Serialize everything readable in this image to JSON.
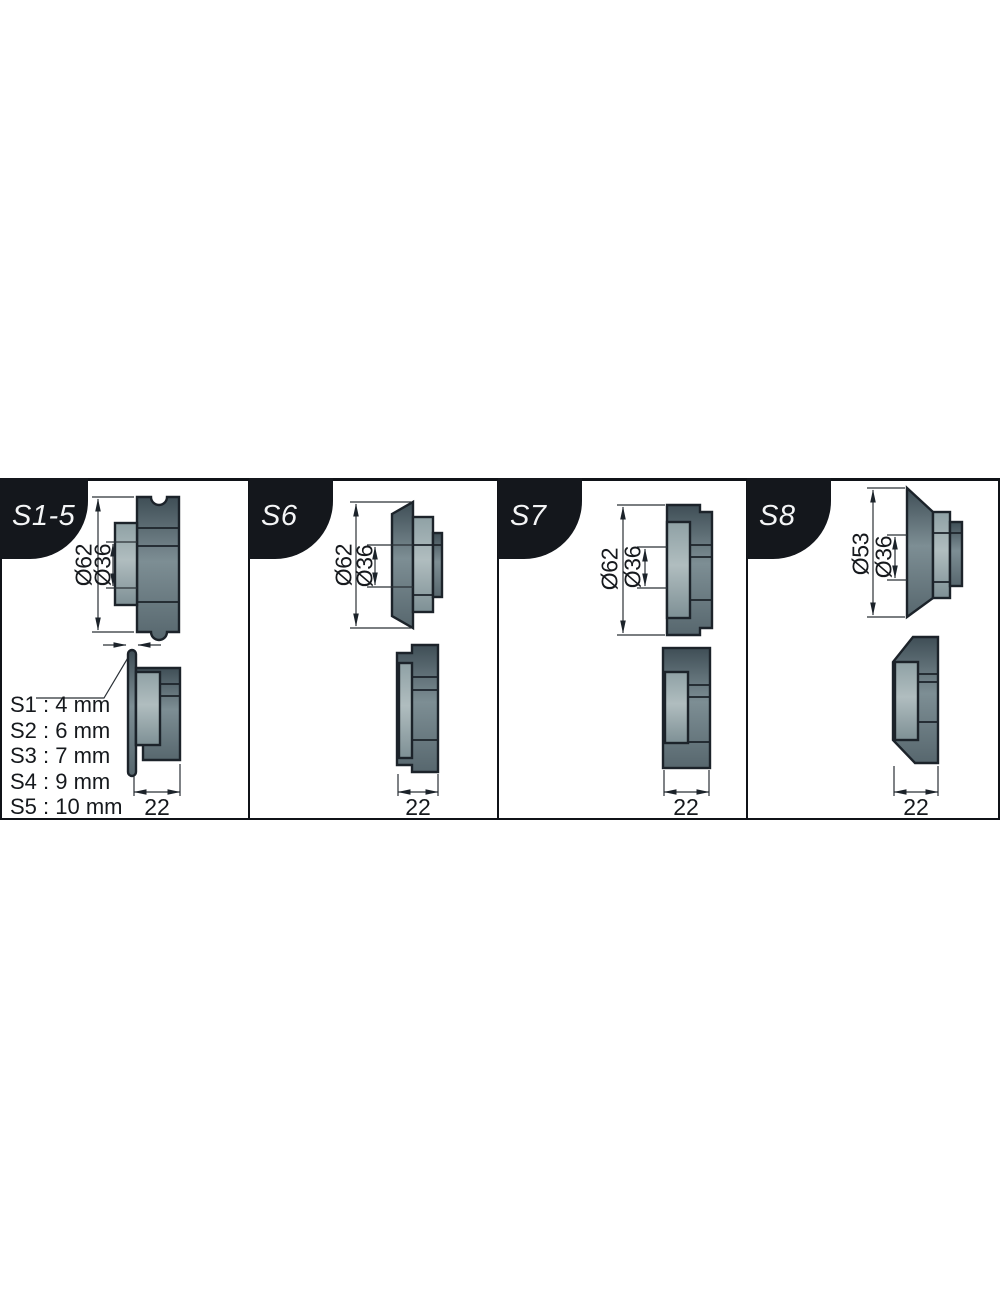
{
  "panels": [
    {
      "id": "S1-5",
      "tab_label": "S1-5",
      "outer_diameter_label": "Ø62",
      "hub_diameter_label": "Ø36",
      "width_label": "22",
      "gap_legend": [
        "S1 : 4 mm",
        "S2 : 6 mm",
        "S3 : 7 mm",
        "S4 : 9 mm",
        "S5 : 10 mm"
      ]
    },
    {
      "id": "S6",
      "tab_label": "S6",
      "outer_diameter_label": "Ø62",
      "hub_diameter_label": "Ø36",
      "width_label": "22"
    },
    {
      "id": "S7",
      "tab_label": "S7",
      "outer_diameter_label": "Ø62",
      "hub_diameter_label": "Ø36",
      "width_label": "22"
    },
    {
      "id": "S8",
      "tab_label": "S8",
      "outer_diameter_label": "Ø53",
      "hub_diameter_label": "Ø36",
      "width_label": "22"
    }
  ],
  "colors": {
    "tab_background": "#14171c",
    "tab_text": "#f4f5f6",
    "outline": "#1c232a",
    "roller_body": "#5e6e75",
    "roller_hub": "#9aacb0",
    "dimension_line": "#2a3036"
  }
}
